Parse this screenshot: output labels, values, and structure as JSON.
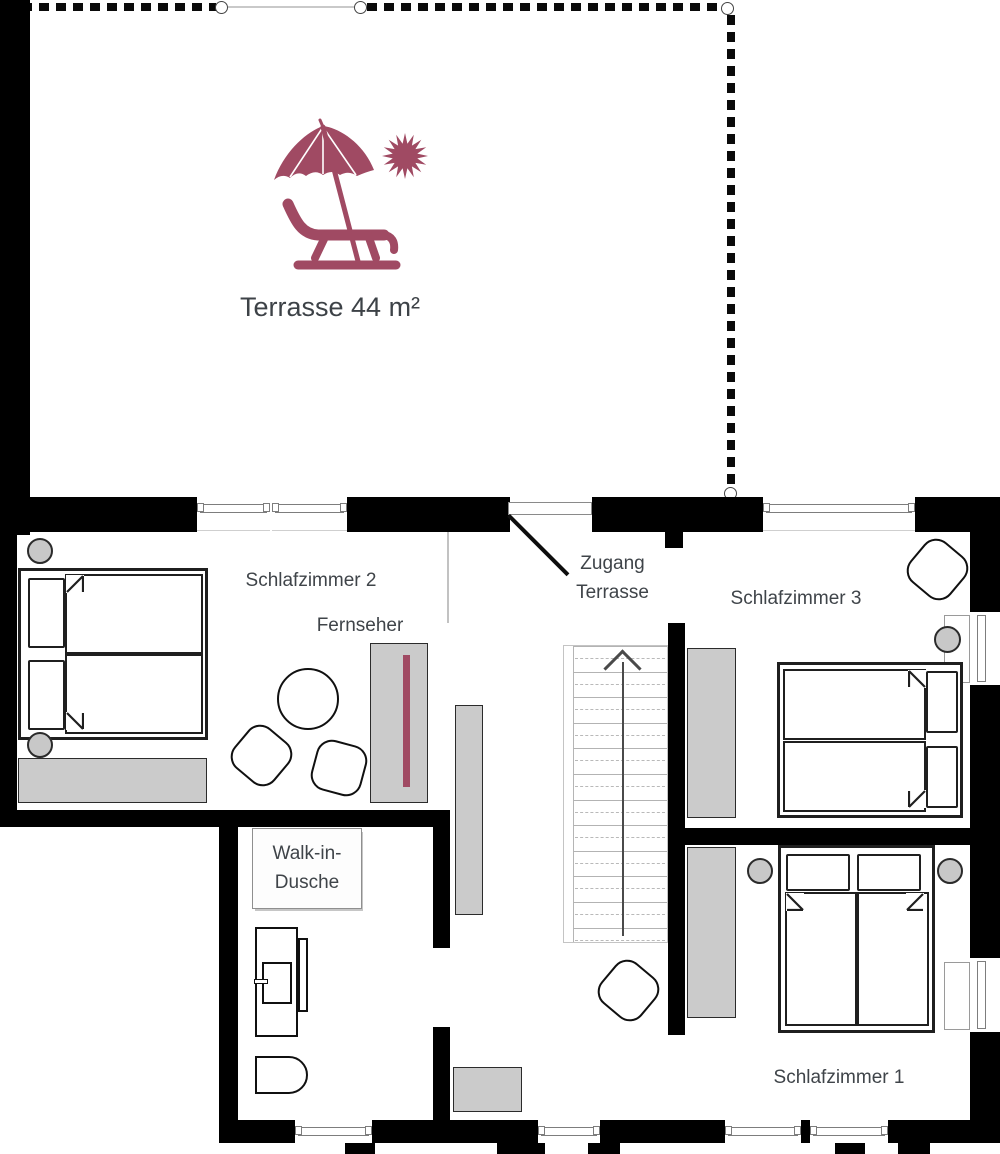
{
  "plan": {
    "terrace": {
      "label": "Terrasse 44 m²"
    },
    "access": {
      "line1": "Zugang",
      "line2": "Terrasse"
    },
    "bedroom2": {
      "label": "Schlafzimmer 2",
      "tv_label": "Fernseher"
    },
    "bedroom3": {
      "label": "Schlafzimmer 3"
    },
    "bedroom1": {
      "label": "Schlafzimmer 1"
    },
    "bathroom": {
      "shower_line1": "Walk-in-",
      "shower_line2": "Dusche"
    },
    "icons": [
      "parasol-lounger-icon",
      "sun-icon",
      "stairs-direction-arrow-icon"
    ],
    "colors": {
      "accent": "#a04a63",
      "wall": "#000000",
      "furniture": "#cbcbcb",
      "text": "#3f4449"
    }
  }
}
